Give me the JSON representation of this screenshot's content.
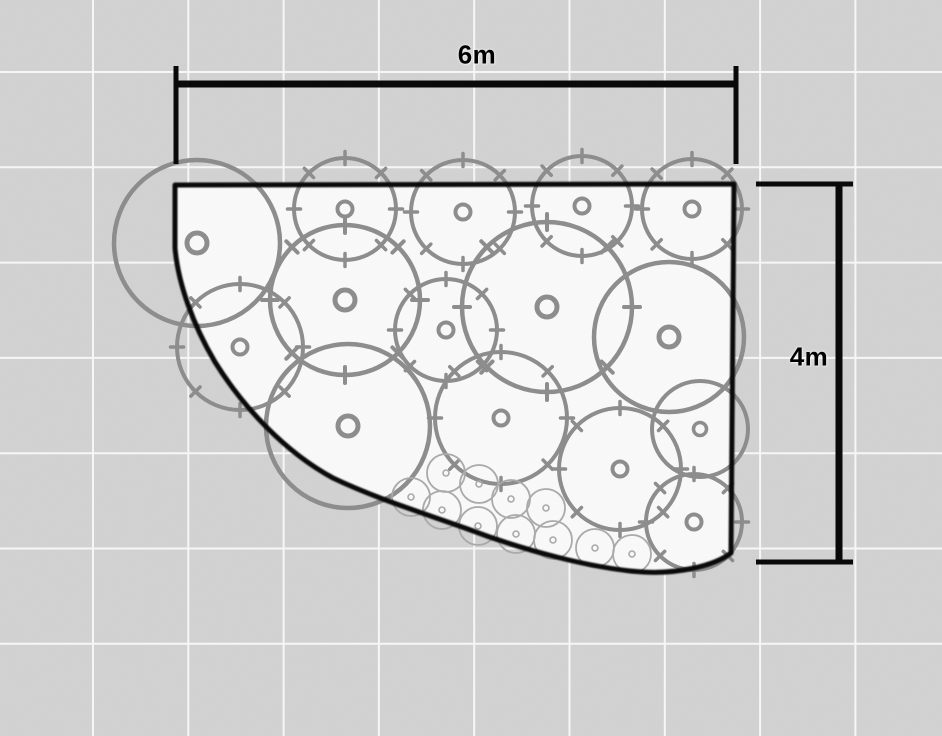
{
  "canvas": {
    "width": 942,
    "height": 736,
    "background": "#d3d3d3",
    "interior_fill": "#fcfcfc",
    "grid": {
      "spacing": 95.3,
      "offset_x": 93,
      "offset_y": 72,
      "color": "#ffffff",
      "line_width": 2,
      "opacity": 0.9
    }
  },
  "outline": {
    "path": "M 175 185 L 734 184 L 731 553 C 714 566 678 574 643 572 C 595 569 525 551 465 528 C 420 512 375 498 333 478 C 285 452 243 407 215 362 C 193 325 178 283 175 248 Z",
    "color": "#060606",
    "width": 5
  },
  "plants": {
    "stroke": "#8b8b8b",
    "small_stroke": "#a9a9a9",
    "ticked": [
      [
        345,
        209,
        51
      ],
      [
        463,
        212,
        52
      ],
      [
        582,
        206,
        50
      ],
      [
        692,
        209,
        50
      ],
      [
        345,
        300,
        75
      ],
      [
        446,
        330,
        51
      ],
      [
        547,
        307,
        85
      ],
      [
        240,
        347,
        63
      ],
      [
        501,
        418,
        66
      ],
      [
        620,
        469,
        61
      ],
      [
        694,
        522,
        48
      ]
    ],
    "plain": [
      [
        197,
        243,
        83
      ],
      [
        669,
        337,
        75
      ],
      [
        348,
        426,
        82
      ],
      [
        700,
        429,
        48
      ]
    ],
    "small_radius": 19,
    "small": [
      [
        446,
        473
      ],
      [
        479,
        484
      ],
      [
        411,
        497
      ],
      [
        442,
        510
      ],
      [
        511,
        499
      ],
      [
        478,
        526
      ],
      [
        546,
        508
      ],
      [
        516,
        534
      ],
      [
        553,
        540
      ],
      [
        595,
        548
      ],
      [
        632,
        554
      ]
    ]
  },
  "dimensions": {
    "color": "#000000",
    "top": {
      "label": "6m",
      "y": 84,
      "x1": 176,
      "x2": 736,
      "tick_y1": 66,
      "tick_y2": 164,
      "line_width": 7,
      "tick_width": 5,
      "label_x": 477,
      "label_y": 55
    },
    "right": {
      "label": "4m",
      "x": 839,
      "y1": 184,
      "y2": 562,
      "tick_x1": 756,
      "tick_x2": 853,
      "line_width": 7,
      "tick_width": 5,
      "label_x": 809,
      "label_y": 357
    }
  }
}
